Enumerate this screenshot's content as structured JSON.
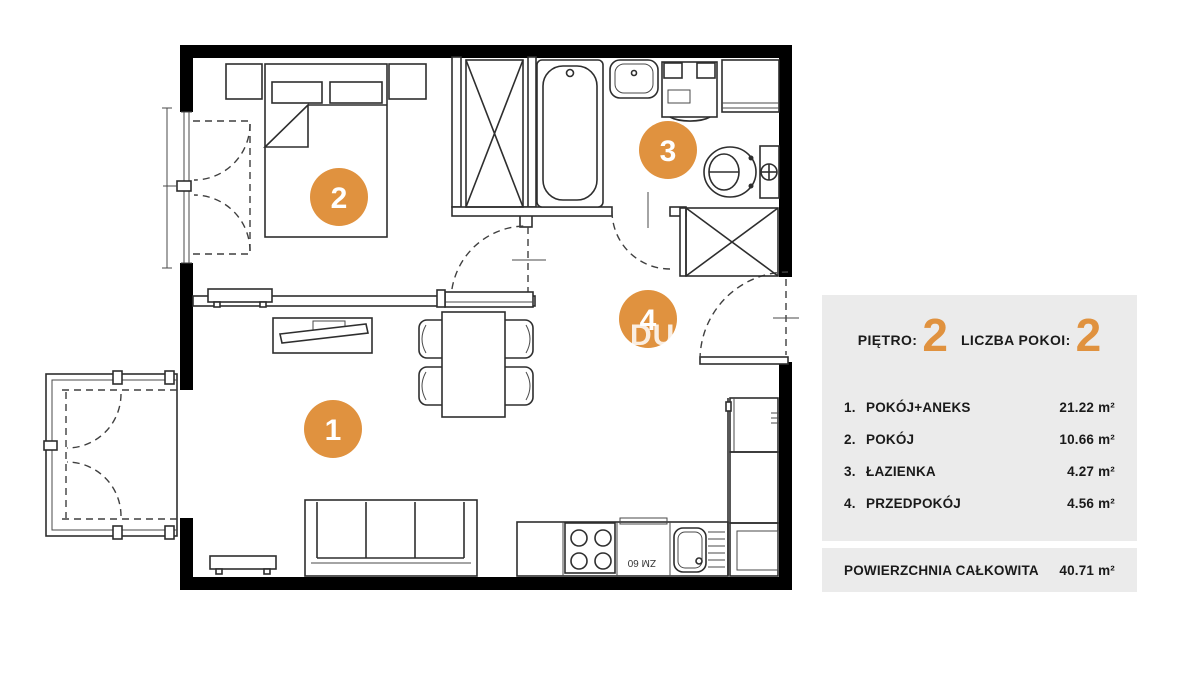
{
  "panel": {
    "floor_label": "PIĘTRO:",
    "floor_value": "2",
    "rooms_label": "LICZBA POKOI:",
    "rooms_value": "2",
    "rows": [
      {
        "num": "1.",
        "name": "POKÓJ+ANEKS",
        "area": "21.22 m²"
      },
      {
        "num": "2.",
        "name": "POKÓJ",
        "area": "10.66 m²"
      },
      {
        "num": "3.",
        "name": "ŁAZIENKA",
        "area": "4.27 m²"
      },
      {
        "num": "4.",
        "name": "PRZEDPOKÓJ",
        "area": "4.56 m²"
      }
    ],
    "total_label": "POWIERZCHNIA CAŁKOWITA",
    "total_value": "40.71 m²"
  },
  "floorplan": {
    "room_markers": [
      {
        "id": "1"
      },
      {
        "id": "2"
      },
      {
        "id": "3"
      },
      {
        "id": "4"
      }
    ],
    "appliance_label": "ZM 60",
    "watermark": "DU"
  },
  "colors": {
    "accent": "#E0923F",
    "panel_bg": "#EBEBEB",
    "wall": "#000000"
  }
}
